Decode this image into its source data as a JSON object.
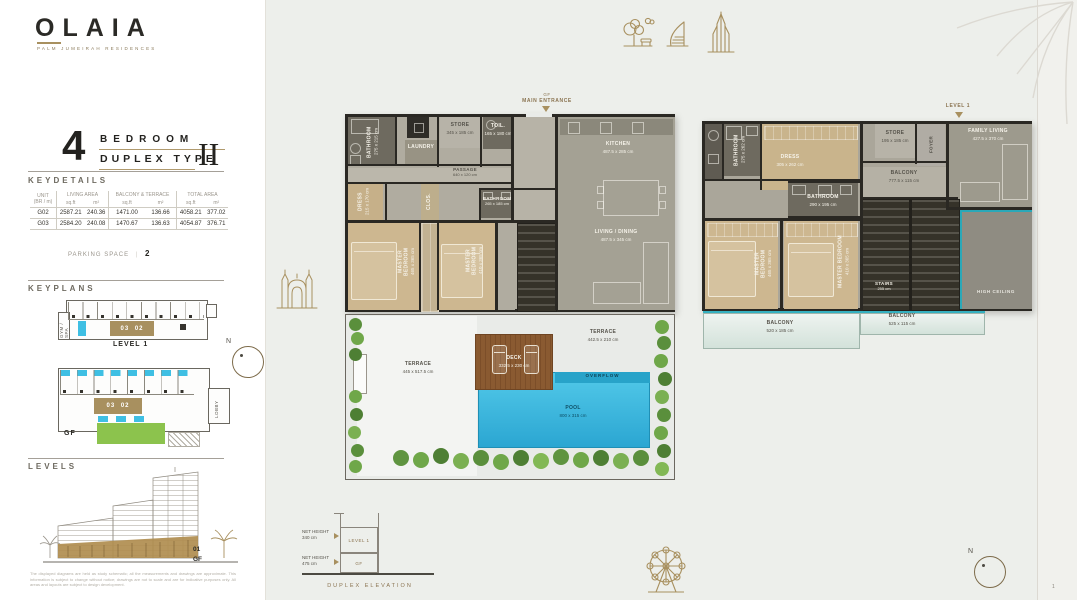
{
  "brand": {
    "name": "OLAIA",
    "tagline": "PALM JUMEIRAH RESIDENCES"
  },
  "title": {
    "number": "4",
    "word1": "BEDROOM",
    "word2": "DUPLEX TYPE",
    "roman": "II"
  },
  "keydetails": {
    "heading": "KEYDETAILS",
    "columns": {
      "unit_l1": "UNIT",
      "unit_l2": "(BR / m)",
      "living": "LIVING AREA",
      "balcony": "BALCONY & TERRACE",
      "total": "TOTAL AREA",
      "sqft": "sq.ft",
      "m2": "m²"
    },
    "rows": [
      {
        "unit": "G02",
        "living_sqft": "2587.21",
        "living_m2": "240.36",
        "bt_sqft": "1471.00",
        "bt_m2": "136.66",
        "total_sqft": "4058.21",
        "total_m2": "377.02"
      },
      {
        "unit": "G03",
        "living_sqft": "2584.20",
        "living_m2": "240.08",
        "bt_sqft": "1470.67",
        "bt_m2": "136.63",
        "total_sqft": "4054.87",
        "total_m2": "376.71"
      }
    ],
    "parking_label": "PARKING SPACE",
    "parking_value": "2"
  },
  "keyplans": {
    "heading": "KEYPLANS",
    "units": "03 02",
    "gym": "GYM / SPA",
    "lobby": "LOBBY",
    "level1_caption": "LEVEL 1",
    "gf_caption": "GF"
  },
  "levels": {
    "heading": "LEVELS",
    "floor_up": "01",
    "floor_gf": "GF",
    "disclaimer": "The displayed diagrams are held as study schematic; all the measurements and drawings are approximate. This information is subject to change without notice; drawings are not to scale and are for indicative purposes only. All areas and layouts are subject to design development."
  },
  "icons": {
    "landmarks": [
      "park-trees",
      "burj-al-arab",
      "burj-khalifa"
    ],
    "corner_decor": "palm-leaf",
    "left_decor": "archway",
    "bottom_decor": "ferris-wheel",
    "compass": "compass-north"
  },
  "compass": {
    "north": "N"
  },
  "page": {
    "marker": "1"
  },
  "plans": {
    "gf": {
      "entrance_line1": "GF",
      "entrance_line2": "MAIN ENTRANCE",
      "rooms": {
        "bathroom1": {
          "name": "BATHROOM",
          "dims": "275 x 215 cm"
        },
        "laundry": {
          "name": "LAUNDRY"
        },
        "store": {
          "name": "STORE",
          "dims": "345 x 185 cm"
        },
        "toilet": {
          "name": "TOIL.",
          "dims": "165 x 180 cm"
        },
        "passage": {
          "name": "PASSAGE",
          "dims": "640 x 120 cm"
        },
        "dress": {
          "name": "DRESS",
          "dims": "215 x 170 cm"
        },
        "closet": {
          "name": "CLOS."
        },
        "bathroom2": {
          "name": "BATHROOM",
          "dims": "265 x 185 cm"
        },
        "bedroom1": {
          "name": "MASTER BEDROOM",
          "dims": "465 x 365 cm"
        },
        "bedroom2": {
          "name": "MASTER BEDROOM",
          "dims": "410 x 365 cm"
        },
        "kitchen": {
          "name": "KITCHEN",
          "dims": "487.5 x 285 cm"
        },
        "living": {
          "name": "LIVING / DINING",
          "dims": "487.5 x 345 cm"
        },
        "terrace1": {
          "name": "TERRACE",
          "dims": "445 x 517.5 cm"
        },
        "terrace2": {
          "name": "TERRACE",
          "dims": "442.5 x 210 cm"
        },
        "deck": {
          "name": "DECK",
          "dims": "332.5 x 230 cm"
        },
        "overflow": {
          "name": "OVERFLOW"
        },
        "pool": {
          "name": "POOL",
          "dims": "800 x 315 cm"
        }
      }
    },
    "level1": {
      "entrance": "LEVEL 1",
      "rooms": {
        "bathroom1": {
          "name": "BATHROOM",
          "dims": "275 x 262 cm"
        },
        "dress": {
          "name": "DRESS",
          "dims": "305 x 262 cm"
        },
        "bathroom2": {
          "name": "BATHROOM",
          "dims": "290 x 195 cm"
        },
        "store": {
          "name": "STORE",
          "dims": "195 x 185 cm"
        },
        "foyer": {
          "name": "FOYER"
        },
        "family_living": {
          "name": "FAMILY LIVING",
          "dims": "427.5 x 370 cm"
        },
        "inner_balcony": {
          "name": "BALCONY",
          "dims": "777.5 x 115 cm"
        },
        "bedroom1": {
          "name": "MASTER BEDROOM",
          "dims": "465 x 365 cm"
        },
        "bedroom2": {
          "name": "MASTER BEDROOM",
          "dims": "410 x 365 cm"
        },
        "stairs": {
          "name": "STAIRS",
          "dims": "255 cm"
        },
        "high_ceiling": {
          "name": "HIGH CEILING"
        },
        "balcony1": {
          "name": "BALCONY",
          "dims": "520 x 185 cm"
        },
        "balcony2": {
          "name": "BALCONY",
          "dims": "525 x 115 cm"
        }
      }
    }
  },
  "elevation": {
    "label1": "NET HEIGHT",
    "value1": "340 cm",
    "box1": "LEVEL 1",
    "label2": "NET HEIGHT",
    "value2": "475 cm",
    "box2": "GF",
    "caption": "DUPLEX ELEVATION"
  }
}
